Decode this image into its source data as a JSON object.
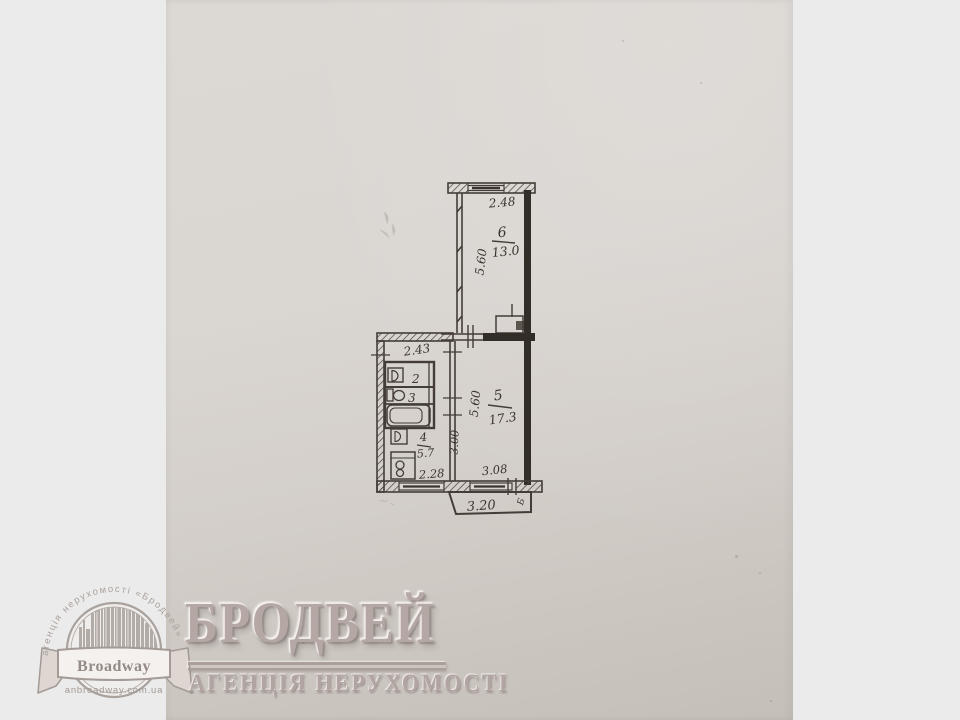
{
  "floor_plan": {
    "rooms": [
      {
        "number": "6",
        "area": "13.0",
        "width": "2.48",
        "depth": "5.60"
      },
      {
        "number": "5",
        "area": "17.3",
        "width": "3.08",
        "depth": "5.60"
      },
      {
        "number": "4",
        "area": "5.7",
        "width": "2.28",
        "depth": "3.00"
      },
      {
        "number": "3"
      },
      {
        "number": "2"
      }
    ],
    "hall_width": "2.43",
    "balcony": {
      "width": "3.20",
      "mark": "Б"
    }
  },
  "watermark": {
    "title": "БРОДВЕЙ",
    "subtitle": "АГЕНЦІЯ НЕРУХОМОСТІ",
    "emblem": {
      "arc_text": "агенція нерухомості «Бродвей»",
      "banner": "Broadway",
      "website": "anbroadway.com.ua"
    }
  },
  "colors": {
    "margin_bg": "#ebebeb",
    "paper": "#d8d4d0",
    "ink": "#3b3530",
    "wall_fill": "#332d28",
    "watermark": "#b3a6a2"
  }
}
